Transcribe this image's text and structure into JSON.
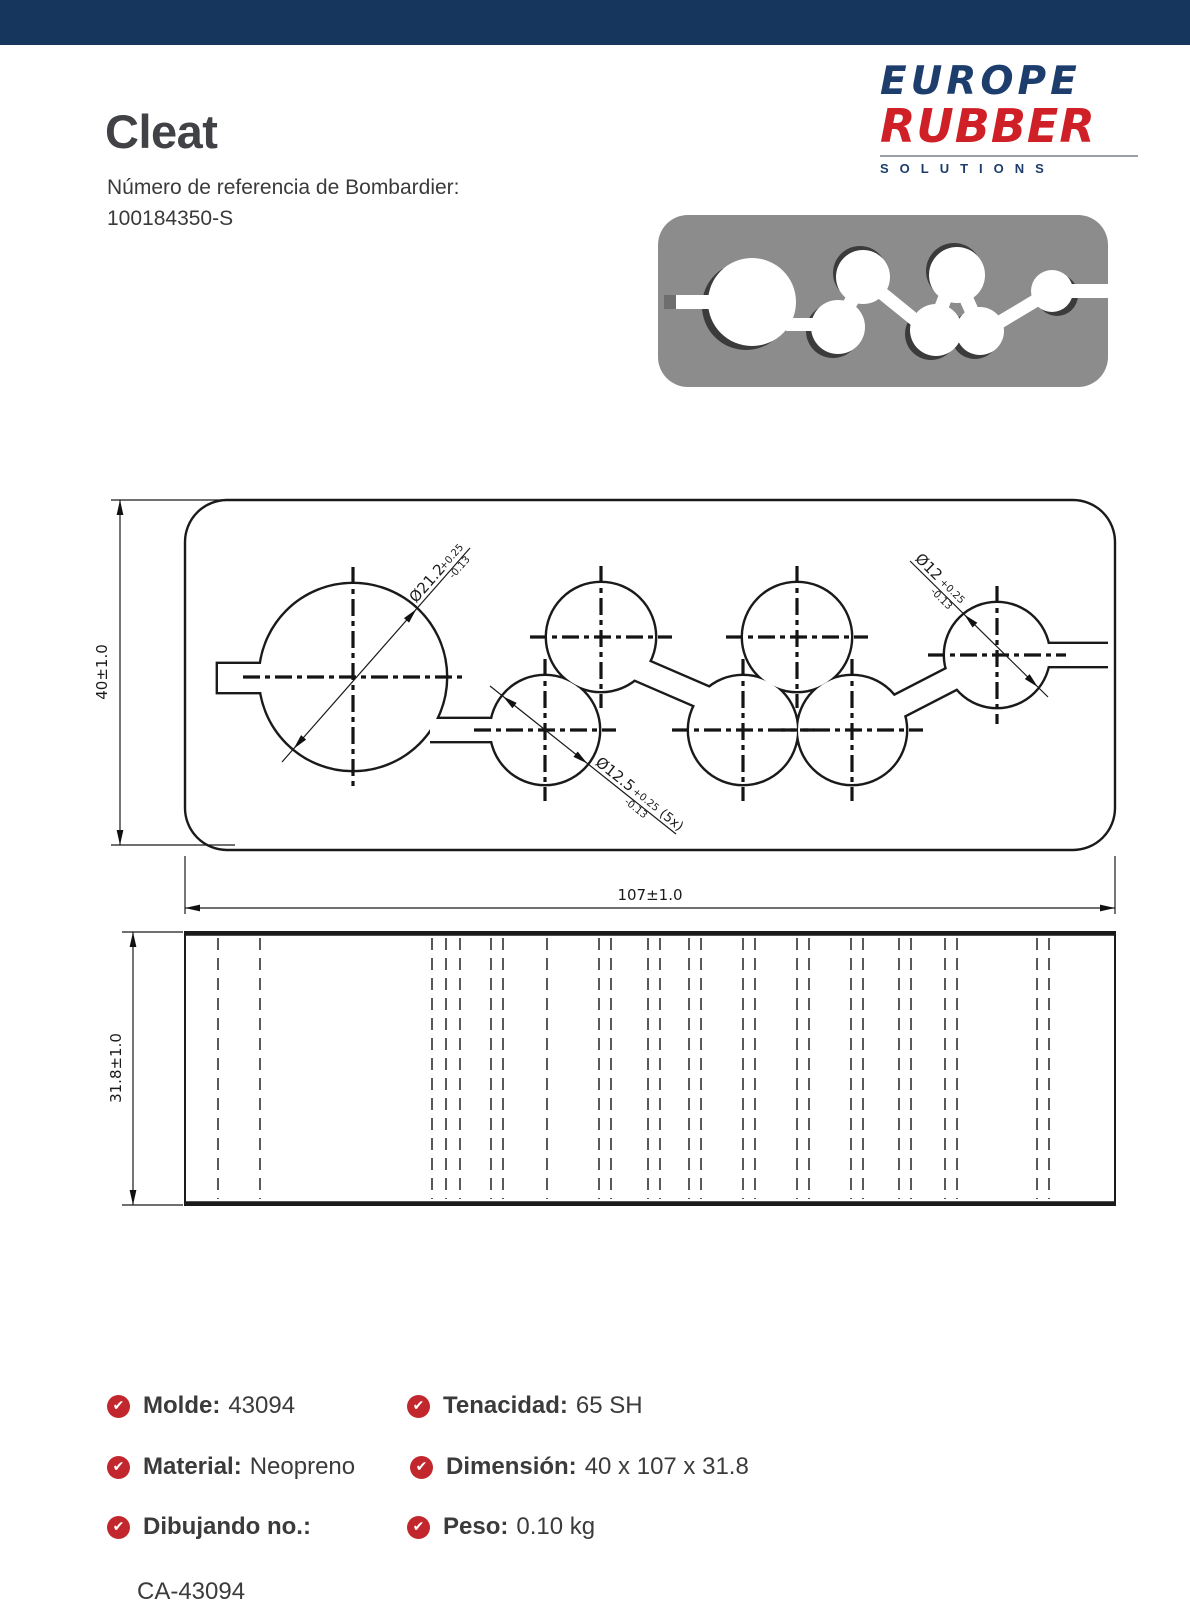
{
  "header": {
    "bar": ""
  },
  "title": {
    "product": "Cleat",
    "ref_label": "Número de referencia de Bombardier:",
    "ref_number": "100184350-S"
  },
  "logo": {
    "line1": "EUROPE",
    "line2": "RUBBER",
    "line3": "SOLUTIONS"
  },
  "colors": {
    "header_navy": "#17365d",
    "logo_navy": "#1d3d6c",
    "logo_red": "#d02027",
    "check_red": "#c1272d",
    "render_gray": "#8c8c8c"
  },
  "icons": {
    "check_glyph": "✔"
  },
  "drawing": {
    "top_view": {
      "height_label": "40±1.0",
      "width_label": "107±1.0",
      "callout_large": {
        "text": "Ø21.2",
        "plus": "+0.25",
        "minus": "-0.13"
      },
      "callout_five": {
        "text": "Ø12.5",
        "plus": "+0.25",
        "minus": "-0.13",
        "count": "(5x)"
      },
      "callout_right": {
        "text": "Ø12",
        "plus": "+0.25",
        "minus": "-0.13"
      }
    },
    "side_view": {
      "height_label": "31.8±1.0"
    }
  },
  "specs": {
    "left": [
      {
        "label": "Molde:",
        "value": "43094"
      },
      {
        "label": "Material:",
        "value": "Neopreno"
      },
      {
        "label": "Dibujando no.:",
        "value": "CA-43094"
      }
    ],
    "right": [
      {
        "label": "Tenacidad:",
        "value": "65 SH"
      },
      {
        "label": "Dimensión:",
        "value": "40 x 107 x 31.8"
      },
      {
        "label": "Peso:",
        "value": "0.10 kg"
      }
    ]
  }
}
